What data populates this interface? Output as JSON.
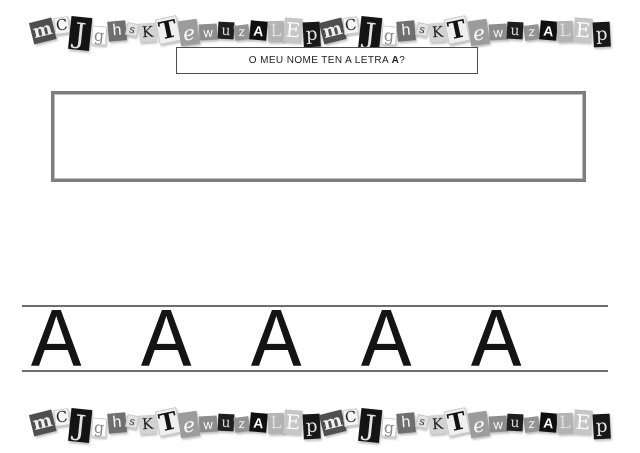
{
  "page": {
    "title": "letter-a-worksheet",
    "background": "#ffffff"
  },
  "question": {
    "prefix": "O MEU NOME TEN A LETRA ",
    "bold_letter": "A",
    "suffix": "?"
  },
  "practice": {
    "letters": [
      "A",
      "A",
      "A",
      "A",
      "A"
    ]
  },
  "ransom": {
    "sequence": "mCJghsKTewuzALEp",
    "repeat": 2,
    "tiles": [
      {
        "letter": "m",
        "bg": "#4f4f4f",
        "fg": "#f0f0f0",
        "font": "serif",
        "weight": 700,
        "w": 23,
        "h": 22,
        "size": 18,
        "rot": -14,
        "dy": 1,
        "edge": false
      },
      {
        "letter": "C",
        "bg": "#f5f5f5",
        "fg": "#2a2a2a",
        "font": "serif",
        "weight": 400,
        "w": 15,
        "h": 17,
        "size": 15,
        "rot": -8,
        "dy": -5,
        "edge": true
      },
      {
        "letter": "J",
        "bg": "#141414",
        "fg": "#e3e3e3",
        "font": "serif",
        "weight": 400,
        "w": 21,
        "h": 33,
        "size": 28,
        "rot": 6,
        "dy": 3,
        "edge": false
      },
      {
        "letter": "g",
        "bg": "#ffffff",
        "fg": "#8a8a8a",
        "font": "serif",
        "weight": 400,
        "w": 15,
        "h": 19,
        "size": 16,
        "rot": 4,
        "dy": 5,
        "edge": true
      },
      {
        "letter": "h",
        "bg": "#6f6f6f",
        "fg": "#fafafa",
        "font": "sans",
        "weight": 400,
        "w": 18,
        "h": 20,
        "size": 16,
        "rot": -5,
        "dy": 1,
        "edge": false
      },
      {
        "letter": "s",
        "bg": "#e2e2e2",
        "fg": "#3a3a3a",
        "font": "serif",
        "weight": 400,
        "w": 12,
        "h": 13,
        "size": 11,
        "rot": 12,
        "dy": -1,
        "edge": true
      },
      {
        "letter": "K",
        "bg": "#d3d3d3",
        "fg": "#1c1c1c",
        "font": "serif",
        "weight": 400,
        "w": 17,
        "h": 19,
        "size": 15,
        "rot": -4,
        "dy": 2,
        "edge": false
      },
      {
        "letter": "T",
        "bg": "#efefef",
        "fg": "#111111",
        "font": "serif",
        "weight": 700,
        "w": 22,
        "h": 26,
        "size": 24,
        "rot": -12,
        "dy": 0,
        "edge": true
      },
      {
        "letter": "e",
        "bg": "#9c9c9c",
        "fg": "#ffffff",
        "font": "script",
        "weight": 400,
        "w": 19,
        "h": 25,
        "size": 20,
        "rot": -8,
        "dy": 2,
        "edge": false
      },
      {
        "letter": "w",
        "bg": "#8d8d8d",
        "fg": "#fcfcfc",
        "font": "sans",
        "weight": 400,
        "w": 18,
        "h": 16,
        "size": 13,
        "rot": -3,
        "dy": 2,
        "edge": false
      },
      {
        "letter": "u",
        "bg": "#1f1f1f",
        "fg": "#d8d8d8",
        "font": "serif",
        "weight": 400,
        "w": 16,
        "h": 17,
        "size": 14,
        "rot": 3,
        "dy": 0,
        "edge": false
      },
      {
        "letter": "z",
        "bg": "#939393",
        "fg": "#f6f6f6",
        "font": "script",
        "weight": 400,
        "w": 15,
        "h": 15,
        "size": 13,
        "rot": -7,
        "dy": 2,
        "edge": false
      },
      {
        "letter": "A",
        "bg": "#0f0f0f",
        "fg": "#fafafa",
        "font": "sans",
        "weight": 700,
        "w": 17,
        "h": 19,
        "size": 14,
        "rot": 5,
        "dy": 0,
        "edge": false
      },
      {
        "letter": "L",
        "bg": "#b3b3b3",
        "fg": "#dedede",
        "font": "serif",
        "weight": 400,
        "w": 16,
        "h": 21,
        "size": 17,
        "rot": -2,
        "dy": 1,
        "edge": false
      },
      {
        "letter": "E",
        "bg": "#c6c6c6",
        "fg": "#fdfdfd",
        "font": "serif",
        "weight": 400,
        "w": 18,
        "h": 24,
        "size": 20,
        "rot": 4,
        "dy": 0,
        "edge": false
      },
      {
        "letter": "p",
        "bg": "#181818",
        "fg": "#e8e8e8",
        "font": "serif",
        "weight": 400,
        "w": 17,
        "h": 25,
        "size": 18,
        "rot": -3,
        "dy": 4,
        "edge": false
      }
    ]
  },
  "colors": {
    "answer_box_border": "#7d7d7d",
    "question_box_border": "#4d4d4d",
    "writing_line": "#6e6e6e",
    "practice_letter": "#141414"
  }
}
